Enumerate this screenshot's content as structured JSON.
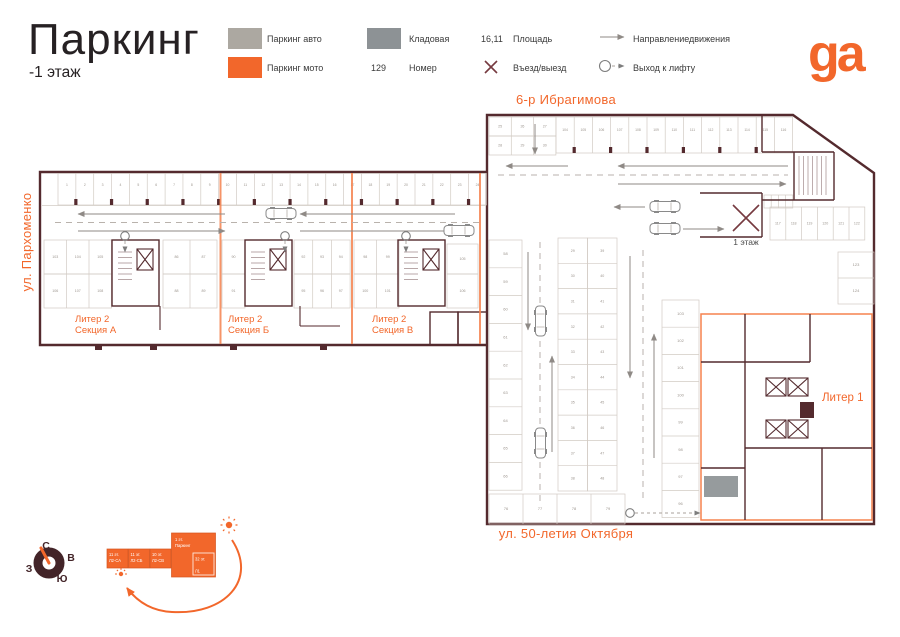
{
  "header": {
    "title": "Паркинг",
    "subtitle": "-1 этаж",
    "logo": "ga"
  },
  "legend": {
    "auto": {
      "label": "Паркинг авто"
    },
    "moto": {
      "label": "Паркинг мото"
    },
    "storage": {
      "label": "Кладовая"
    },
    "number": {
      "sample": "129",
      "label": "Номер"
    },
    "area": {
      "sample": "16,11",
      "label": "Площадь"
    },
    "entry": {
      "label": "Въезд/выезд"
    },
    "direction": {
      "label": "Направлениедвижения"
    },
    "lift": {
      "label": "Выход к лифту"
    }
  },
  "streets": {
    "top": "6-р Ибрагимова",
    "left": "ул. Пархоменко",
    "bottom": "ул. 50-летия Октября"
  },
  "plan_labels": {
    "sec_a": [
      "Литер 2",
      "Секция А"
    ],
    "sec_b": [
      "Литер 2",
      "Секция Б"
    ],
    "sec_v": [
      "Литер 2",
      "Секция В"
    ],
    "liter1": "Литер 1",
    "floor1": "1 этаж"
  },
  "compass": {
    "n": "С",
    "e": "В",
    "w": "З",
    "s": "Ю"
  },
  "keyplan": {
    "blocks": [
      [
        "11 эт.",
        "Л2-СА"
      ],
      [
        "11 эт.",
        "Л2-СБ"
      ],
      [
        "10 эт.",
        "Л2-СВ"
      ]
    ],
    "main": [
      "1 эт.",
      "Паркинг"
    ],
    "inner": [
      "32 эт.",
      "Л1"
    ]
  },
  "colors": {
    "orange": "#F2672B",
    "orange_soft": "#F5824E",
    "wall": "#542A2E",
    "wall_dark": "#432428",
    "entry_x": "#763A40",
    "parking_auto": "#ACA8A1",
    "storage": "#8D9295",
    "cell_line": "#D2CBC4",
    "arrow": "#8F8A86",
    "tiny_text": "#9C958E",
    "ink": "#262123",
    "text": "#3A3A3A"
  },
  "plan": {
    "rows": [
      {
        "type": "h",
        "x": 58,
        "y": 173.5,
        "w": 17.85,
        "h": 31.5,
        "count": 24,
        "start": 1,
        "numY": 186,
        "fs": 3.4,
        "pillars": true
      },
      {
        "type": "h",
        "x": 44,
        "y": 240,
        "w": 22.5,
        "h": 34,
        "count": 3,
        "start": 103
      },
      {
        "type": "h",
        "x": 44,
        "y": 274,
        "w": 22.5,
        "h": 34,
        "count": 3,
        "start": 106
      },
      {
        "type": "h",
        "x": 163,
        "y": 240,
        "w": 27,
        "h": 34,
        "count": 2,
        "start": 86
      },
      {
        "type": "h",
        "x": 163,
        "y": 274,
        "w": 27,
        "h": 34,
        "count": 2,
        "start": 88
      },
      {
        "type": "h",
        "x": 222,
        "y": 240,
        "w": 23,
        "h": 34,
        "count": 1,
        "start": 90
      },
      {
        "type": "h",
        "x": 222,
        "y": 274,
        "w": 23,
        "h": 34,
        "count": 1,
        "start": 91
      },
      {
        "type": "h",
        "x": 294,
        "y": 240,
        "w": 18.7,
        "h": 34,
        "count": 3,
        "start": 92
      },
      {
        "type": "h",
        "x": 294,
        "y": 274,
        "w": 18.7,
        "h": 34,
        "count": 3,
        "start": 95
      },
      {
        "type": "h",
        "x": 354,
        "y": 240,
        "w": 22.5,
        "h": 34,
        "count": 2,
        "start": 98
      },
      {
        "type": "h",
        "x": 354,
        "y": 274,
        "w": 22.5,
        "h": 34,
        "count": 2,
        "start": 100
      },
      {
        "type": "h",
        "x": 447,
        "y": 244,
        "w": 31,
        "h": 30,
        "count": 1,
        "start": 105
      },
      {
        "type": "h",
        "x": 447,
        "y": 274,
        "w": 31,
        "h": 34,
        "count": 1,
        "start": 106
      },
      {
        "type": "h",
        "x": 489,
        "y": 117,
        "w": 22.3,
        "h": 19,
        "count": 3,
        "start": 25
      },
      {
        "type": "h",
        "x": 489,
        "y": 136,
        "w": 22.3,
        "h": 19,
        "count": 3,
        "start": 28
      },
      {
        "type": "h",
        "x": 556,
        "y": 117,
        "w": 18.2,
        "h": 36,
        "count": 13,
        "start": 104,
        "numY": 131,
        "fs": 3.4,
        "pillars": true
      },
      {
        "type": "v",
        "x": 489,
        "y": 240,
        "w": 33,
        "h": 27.8,
        "count": 9,
        "start": 58,
        "fs": 4
      },
      {
        "type": "v",
        "x": 558,
        "y": 238,
        "w": 29.5,
        "h": 25.3,
        "count": 10,
        "start": 29,
        "fs": 3.6
      },
      {
        "type": "v",
        "x": 587.5,
        "y": 238,
        "w": 29.5,
        "h": 25.3,
        "count": 10,
        "start": 39,
        "fs": 3.6
      },
      {
        "type": "v",
        "x": 662,
        "y": 300,
        "w": 37,
        "h": 27.2,
        "count": 8,
        "start": 103,
        "step": -1,
        "fs": 4
      },
      {
        "type": "h",
        "x": 489,
        "y": 494,
        "w": 34,
        "h": 30,
        "count": 4,
        "start": 76,
        "fs": 4
      },
      {
        "type": "h",
        "x": 770,
        "y": 207,
        "w": 15.8,
        "h": 33,
        "count": 6,
        "start": 117
      },
      {
        "type": "v",
        "x": 838,
        "y": 252,
        "w": 36,
        "h": 26,
        "count": 2,
        "start": 123,
        "fs": 4
      },
      {
        "type": "h",
        "x": 764,
        "y": 195,
        "w": 7.2,
        "h": 13,
        "count": 4
      }
    ]
  }
}
